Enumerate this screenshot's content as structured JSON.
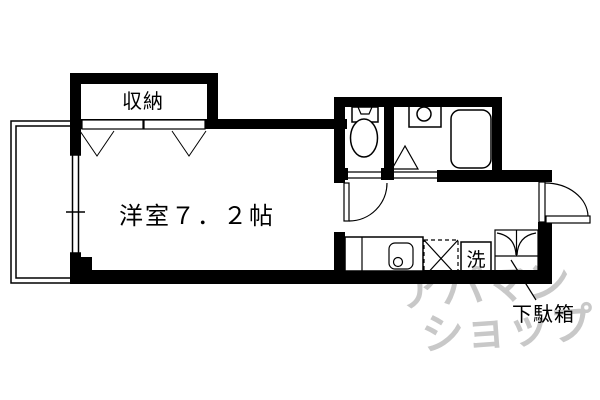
{
  "labels": {
    "closet": "収納",
    "main_room": "洋室７．２帖",
    "washing_machine": "洗",
    "shoe_cabinet": "下駄箱"
  },
  "watermark": {
    "line1": "アパマン",
    "line2": "ショップ",
    "color": "#c8c8c8"
  },
  "colors": {
    "ink": "#000000",
    "background": "#ffffff"
  }
}
